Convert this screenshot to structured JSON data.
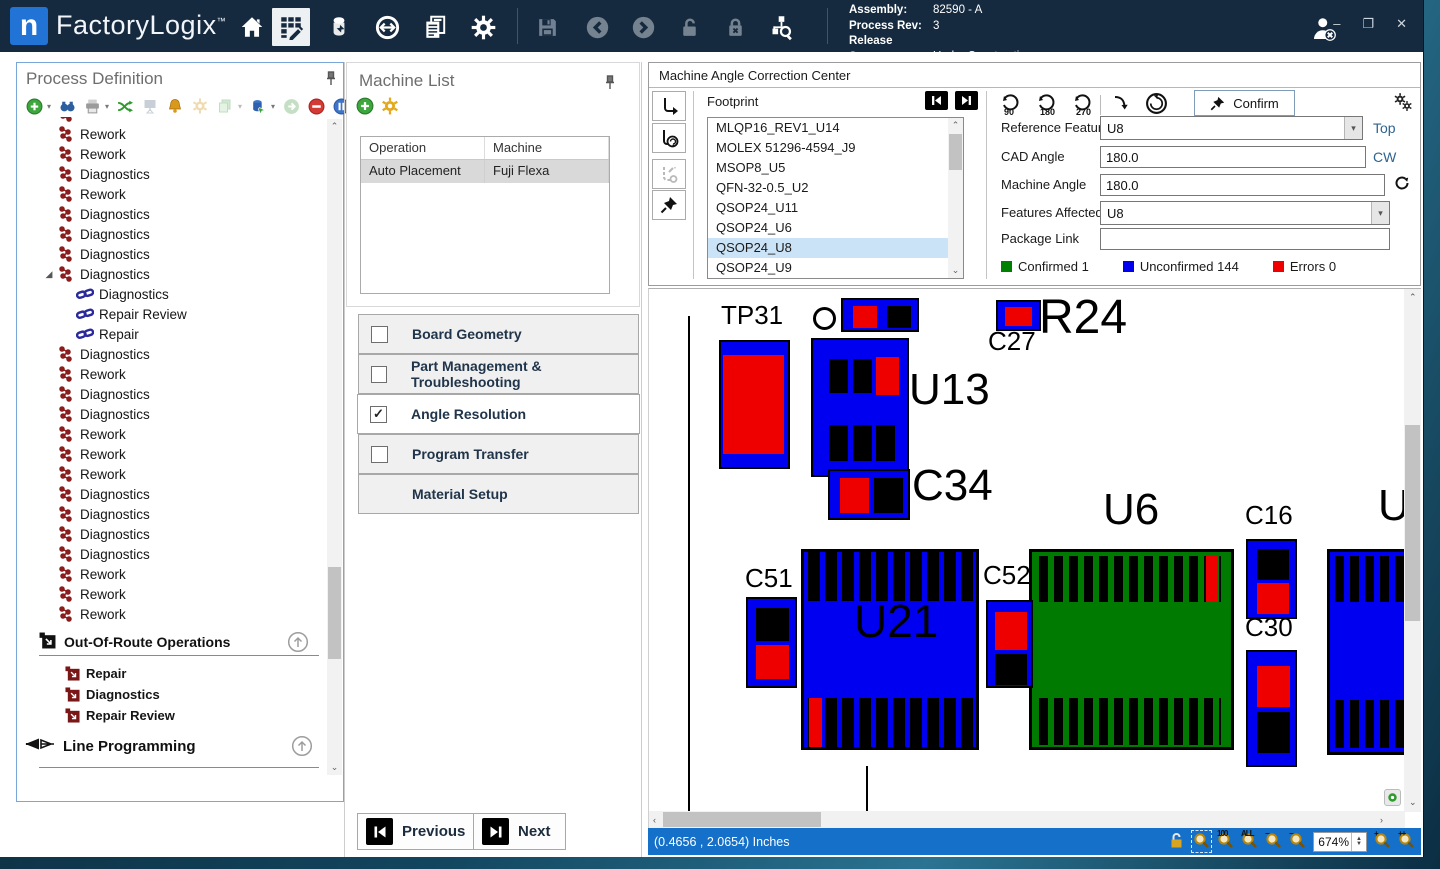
{
  "titlebar": {
    "logo_letter": "n",
    "brand": "FactoryLogix",
    "brand_tm": "™",
    "info": {
      "assembly_label": "Assembly:",
      "assembly_value": "82590 - A",
      "rev_label": "Process Rev:",
      "rev_value": "3",
      "status_label": "Release Status:",
      "status_value": "Under Construction"
    },
    "window_controls": {
      "minimize": "–",
      "maximize": "❐",
      "close": "✕"
    }
  },
  "process_panel": {
    "title": "Process Definition",
    "tree": [
      {
        "label": "",
        "icon": "op",
        "indent": 0
      },
      {
        "label": "Rework",
        "icon": "op",
        "indent": 0
      },
      {
        "label": "Rework",
        "icon": "op",
        "indent": 0
      },
      {
        "label": "Diagnostics",
        "icon": "op",
        "indent": 0
      },
      {
        "label": "Rework",
        "icon": "op",
        "indent": 0
      },
      {
        "label": "Diagnostics",
        "icon": "op",
        "indent": 0
      },
      {
        "label": "Diagnostics",
        "icon": "op",
        "indent": 0
      },
      {
        "label": "Diagnostics",
        "icon": "op",
        "indent": 0
      },
      {
        "label": "Diagnostics",
        "icon": "op",
        "indent": 0,
        "expanded": true
      },
      {
        "label": "Diagnostics",
        "icon": "link",
        "indent": 1
      },
      {
        "label": "Repair Review",
        "icon": "link",
        "indent": 1
      },
      {
        "label": "Repair",
        "icon": "link",
        "indent": 1
      },
      {
        "label": "Diagnostics",
        "icon": "op",
        "indent": 0
      },
      {
        "label": "Rework",
        "icon": "op",
        "indent": 0
      },
      {
        "label": "Diagnostics",
        "icon": "op",
        "indent": 0
      },
      {
        "label": "Diagnostics",
        "icon": "op",
        "indent": 0
      },
      {
        "label": "Rework",
        "icon": "op",
        "indent": 0
      },
      {
        "label": "Rework",
        "icon": "op",
        "indent": 0
      },
      {
        "label": "Rework",
        "icon": "op",
        "indent": 0
      },
      {
        "label": "Diagnostics",
        "icon": "op",
        "indent": 0
      },
      {
        "label": "Diagnostics",
        "icon": "op",
        "indent": 0
      },
      {
        "label": "Diagnostics",
        "icon": "op",
        "indent": 0
      },
      {
        "label": "Diagnostics",
        "icon": "op",
        "indent": 0
      },
      {
        "label": "Rework",
        "icon": "op",
        "indent": 0
      },
      {
        "label": "Rework",
        "icon": "op",
        "indent": 0
      },
      {
        "label": "Rework",
        "icon": "op",
        "indent": 0
      }
    ],
    "oor_title": "Out-Of-Route Operations",
    "oor_items": [
      "Repair",
      "Diagnostics",
      "Repair Review"
    ],
    "line_programming": "Line Programming"
  },
  "machine_list": {
    "title": "Machine List",
    "headers": [
      "Operation",
      "Machine"
    ],
    "rows": [
      [
        "Auto Placement",
        "Fuji Flexa"
      ]
    ]
  },
  "checklist": [
    {
      "label": "Board Geometry",
      "checked": false
    },
    {
      "label": "Part Management & Troubleshooting",
      "checked": false
    },
    {
      "label": "Angle Resolution",
      "checked": true,
      "active": true
    },
    {
      "label": "Program Transfer",
      "checked": false
    },
    {
      "label": "Material Setup",
      "checked": null
    }
  ],
  "wizard": {
    "previous": "Previous",
    "next": "Next"
  },
  "correction_center": {
    "title": "Machine Angle Correction Center",
    "footprint_label": "Footprint",
    "footprints": [
      "MLQP16_REV1_U14",
      "MOLEX 51296-4594_J9",
      "MSOP8_U5",
      "QFN-32-0.5_U2",
      "QSOP24_U11",
      "QSOP24_U6",
      "QSOP24_U8",
      "QSOP24_U9"
    ],
    "selected_footprint": "QSOP24_U8",
    "rotate_buttons": [
      "90",
      "180",
      "270"
    ],
    "confirm_label": "Confirm",
    "fields": {
      "reference_feature": {
        "label": "Reference Feature",
        "value": "U8",
        "suffix": "Top"
      },
      "cad_angle": {
        "label": "CAD Angle",
        "value": "180.0",
        "suffix": "CW"
      },
      "machine_angle": {
        "label": "Machine Angle",
        "value": "180.0"
      },
      "features_affected": {
        "label": "Features Affected",
        "value": "U8"
      },
      "package_link": {
        "label": "Package Link",
        "value": ""
      }
    },
    "legend": [
      {
        "label": "Confirmed",
        "count": "1",
        "color": "#008000"
      },
      {
        "label": "Unconfirmed",
        "count": "144",
        "color": "#0000ee"
      },
      {
        "label": "Errors",
        "count": "0",
        "color": "#ee0000"
      }
    ]
  },
  "viewer": {
    "status_coords": "(0.4656 , 2.0654) Inches",
    "zoom_value": "674%",
    "tools_left": [
      {
        "name": "pan-lock-icon",
        "kind": "lock"
      },
      {
        "name": "zoom-window-icon",
        "kind": "mag",
        "boxed": true
      },
      {
        "name": "zoom-100-icon",
        "kind": "mag",
        "sup": "100"
      },
      {
        "name": "zoom-all-icon",
        "kind": "mag",
        "sup": "ALL"
      },
      {
        "name": "zoom-out-icon",
        "kind": "mag",
        "sup": "−"
      },
      {
        "name": "zoom-out-step-icon",
        "kind": "mag",
        "sup": "−"
      }
    ],
    "tools_right": [
      {
        "name": "zoom-in-icon",
        "kind": "mag",
        "sup": "+"
      },
      {
        "name": "zoom-in-step-icon",
        "kind": "mag",
        "sup": "++"
      }
    ],
    "colors": {
      "blue": "#0000f0",
      "red": "#ee0000",
      "green": "#007a00",
      "black": "#000000"
    },
    "components": [
      {
        "t": "vline",
        "x": 37,
        "y": 24,
        "w": 2,
        "h": 496
      },
      {
        "t": "label",
        "text": "TP31",
        "x": 70,
        "y": 10,
        "s": 26
      },
      {
        "t": "box",
        "name": "TP31",
        "x": 68,
        "y": 48,
        "w": 71,
        "h": 129,
        "bg": "blue",
        "parts": [
          {
            "x": 2,
            "y": 13,
            "w": 61,
            "h": 99,
            "c": "red"
          }
        ]
      },
      {
        "t": "ring",
        "x": 162,
        "y": 15,
        "w": 23,
        "h": 23
      },
      {
        "t": "box",
        "x": 190,
        "y": 6,
        "w": 78,
        "h": 34,
        "bg": "blue",
        "parts": [
          {
            "x": 10,
            "y": 6,
            "w": 24,
            "h": 22,
            "c": "red"
          },
          {
            "x": 44,
            "y": 6,
            "w": 24,
            "h": 22,
            "c": "black"
          }
        ]
      },
      {
        "t": "box",
        "name": "U13",
        "x": 160,
        "y": 46,
        "w": 98,
        "h": 139,
        "bg": "blue",
        "parts": [
          {
            "x": 16,
            "y": 19,
            "w": 19,
            "h": 34,
            "c": "black"
          },
          {
            "x": 40,
            "y": 19,
            "w": 19,
            "h": 34,
            "c": "black"
          },
          {
            "x": 63,
            "y": 17,
            "w": 23,
            "h": 38,
            "c": "red"
          },
          {
            "x": 16,
            "y": 85,
            "w": 19,
            "h": 36,
            "c": "black"
          },
          {
            "x": 40,
            "y": 85,
            "w": 19,
            "h": 36,
            "c": "black"
          },
          {
            "x": 63,
            "y": 85,
            "w": 19,
            "h": 36,
            "c": "black"
          }
        ]
      },
      {
        "t": "label",
        "text": "U13",
        "x": 258,
        "y": 76,
        "s": 44
      },
      {
        "t": "box",
        "name": "C27",
        "x": 345,
        "y": 8,
        "w": 45,
        "h": 31,
        "bg": "blue",
        "parts": [
          {
            "x": 7,
            "y": 5,
            "w": 27,
            "h": 19,
            "c": "red"
          }
        ]
      },
      {
        "t": "label",
        "text": "C27",
        "x": 337,
        "y": 36,
        "s": 26
      },
      {
        "t": "label",
        "text": "R24",
        "x": 388,
        "y": 2,
        "s": 48
      },
      {
        "t": "box",
        "name": "C34",
        "x": 177,
        "y": 177,
        "w": 82,
        "h": 51,
        "bg": "blue",
        "parts": [
          {
            "x": 10,
            "y": 7,
            "w": 29,
            "h": 35,
            "c": "red"
          },
          {
            "x": 44,
            "y": 7,
            "w": 29,
            "h": 35,
            "c": "black"
          }
        ]
      },
      {
        "t": "label",
        "text": "C34",
        "x": 261,
        "y": 172,
        "s": 44
      },
      {
        "t": "label",
        "text": "U6",
        "x": 452,
        "y": 196,
        "s": 44
      },
      {
        "t": "box",
        "name": "U6",
        "x": 378,
        "y": 257,
        "w": 205,
        "h": 201,
        "bg": "green",
        "bw": 3,
        "parts": [
          {
            "st": 1,
            "x": 7,
            "y": 4,
            "w": 182,
            "h": 46,
            "fg": "black",
            "bgc": "green",
            "sw": 9,
            "gap": 6
          },
          {
            "x": 174,
            "y": 4,
            "w": 11,
            "h": 46,
            "c": "red"
          },
          {
            "st": 1,
            "x": 7,
            "y": 146,
            "w": 182,
            "h": 47,
            "fg": "black",
            "bgc": "green",
            "sw": 9,
            "gap": 6
          }
        ]
      },
      {
        "t": "label",
        "text": "C16",
        "x": 594,
        "y": 210,
        "s": 26
      },
      {
        "t": "box",
        "name": "C16",
        "x": 595,
        "y": 247,
        "w": 51,
        "h": 80,
        "bg": "blue",
        "parts": [
          {
            "x": 9,
            "y": 8,
            "w": 32,
            "h": 31,
            "c": "black"
          },
          {
            "x": 9,
            "y": 42,
            "w": 32,
            "h": 31,
            "c": "red"
          }
        ]
      },
      {
        "t": "label",
        "text": "C51",
        "x": 94,
        "y": 273,
        "s": 26
      },
      {
        "t": "box",
        "name": "C51",
        "x": 95,
        "y": 305,
        "w": 51,
        "h": 91,
        "bg": "blue",
        "parts": [
          {
            "x": 8,
            "y": 9,
            "w": 33,
            "h": 33,
            "c": "black"
          },
          {
            "x": 8,
            "y": 46,
            "w": 33,
            "h": 34,
            "c": "red"
          }
        ]
      },
      {
        "t": "box",
        "name": "U21",
        "x": 150,
        "y": 257,
        "w": 178,
        "h": 201,
        "bg": "blue",
        "bw": 3,
        "parts": [
          {
            "st": 1,
            "x": 4,
            "y": 0,
            "w": 166,
            "h": 49,
            "fg": "black",
            "bgc": "blue",
            "sw": 12,
            "gap": 5
          },
          {
            "st": 1,
            "x": 4,
            "y": 146,
            "w": 166,
            "h": 49,
            "fg": "black",
            "bgc": "blue",
            "sw": 12,
            "gap": 5
          },
          {
            "x": 5,
            "y": 146,
            "w": 13,
            "h": 49,
            "c": "red"
          }
        ]
      },
      {
        "t": "label",
        "text": "U21",
        "x": 203,
        "y": 306,
        "s": 46
      },
      {
        "t": "label",
        "text": "C52",
        "x": 332,
        "y": 270,
        "s": 26
      },
      {
        "t": "box",
        "name": "C52",
        "x": 335,
        "y": 308,
        "w": 47,
        "h": 88,
        "bg": "blue",
        "parts": [
          {
            "x": 7,
            "y": 10,
            "w": 32,
            "h": 38,
            "c": "red"
          },
          {
            "x": 7,
            "y": 52,
            "w": 32,
            "h": 31,
            "c": "black"
          }
        ]
      },
      {
        "t": "label",
        "text": "C30",
        "x": 594,
        "y": 322,
        "s": 26
      },
      {
        "t": "box",
        "name": "C30",
        "x": 595,
        "y": 358,
        "w": 51,
        "h": 117,
        "bg": "blue",
        "parts": [
          {
            "x": 9,
            "y": 14,
            "w": 33,
            "h": 41,
            "c": "red"
          },
          {
            "x": 9,
            "y": 60,
            "w": 33,
            "h": 41,
            "c": "black"
          }
        ]
      },
      {
        "t": "label",
        "text": "U",
        "x": 727,
        "y": 192,
        "s": 44
      },
      {
        "t": "box",
        "x": 676,
        "y": 257,
        "w": 88,
        "h": 206,
        "bg": "blue",
        "bw": 3,
        "parts": [
          {
            "st": 1,
            "x": 5,
            "y": 4,
            "w": 72,
            "h": 46,
            "fg": "black",
            "bgc": "blue",
            "sw": 9,
            "gap": 6
          },
          {
            "st": 1,
            "x": 5,
            "y": 148,
            "w": 72,
            "h": 48,
            "fg": "black",
            "bgc": "blue",
            "sw": 9,
            "gap": 6
          }
        ]
      },
      {
        "t": "vline",
        "x": 215,
        "y": 474,
        "w": 2,
        "h": 46
      }
    ]
  }
}
